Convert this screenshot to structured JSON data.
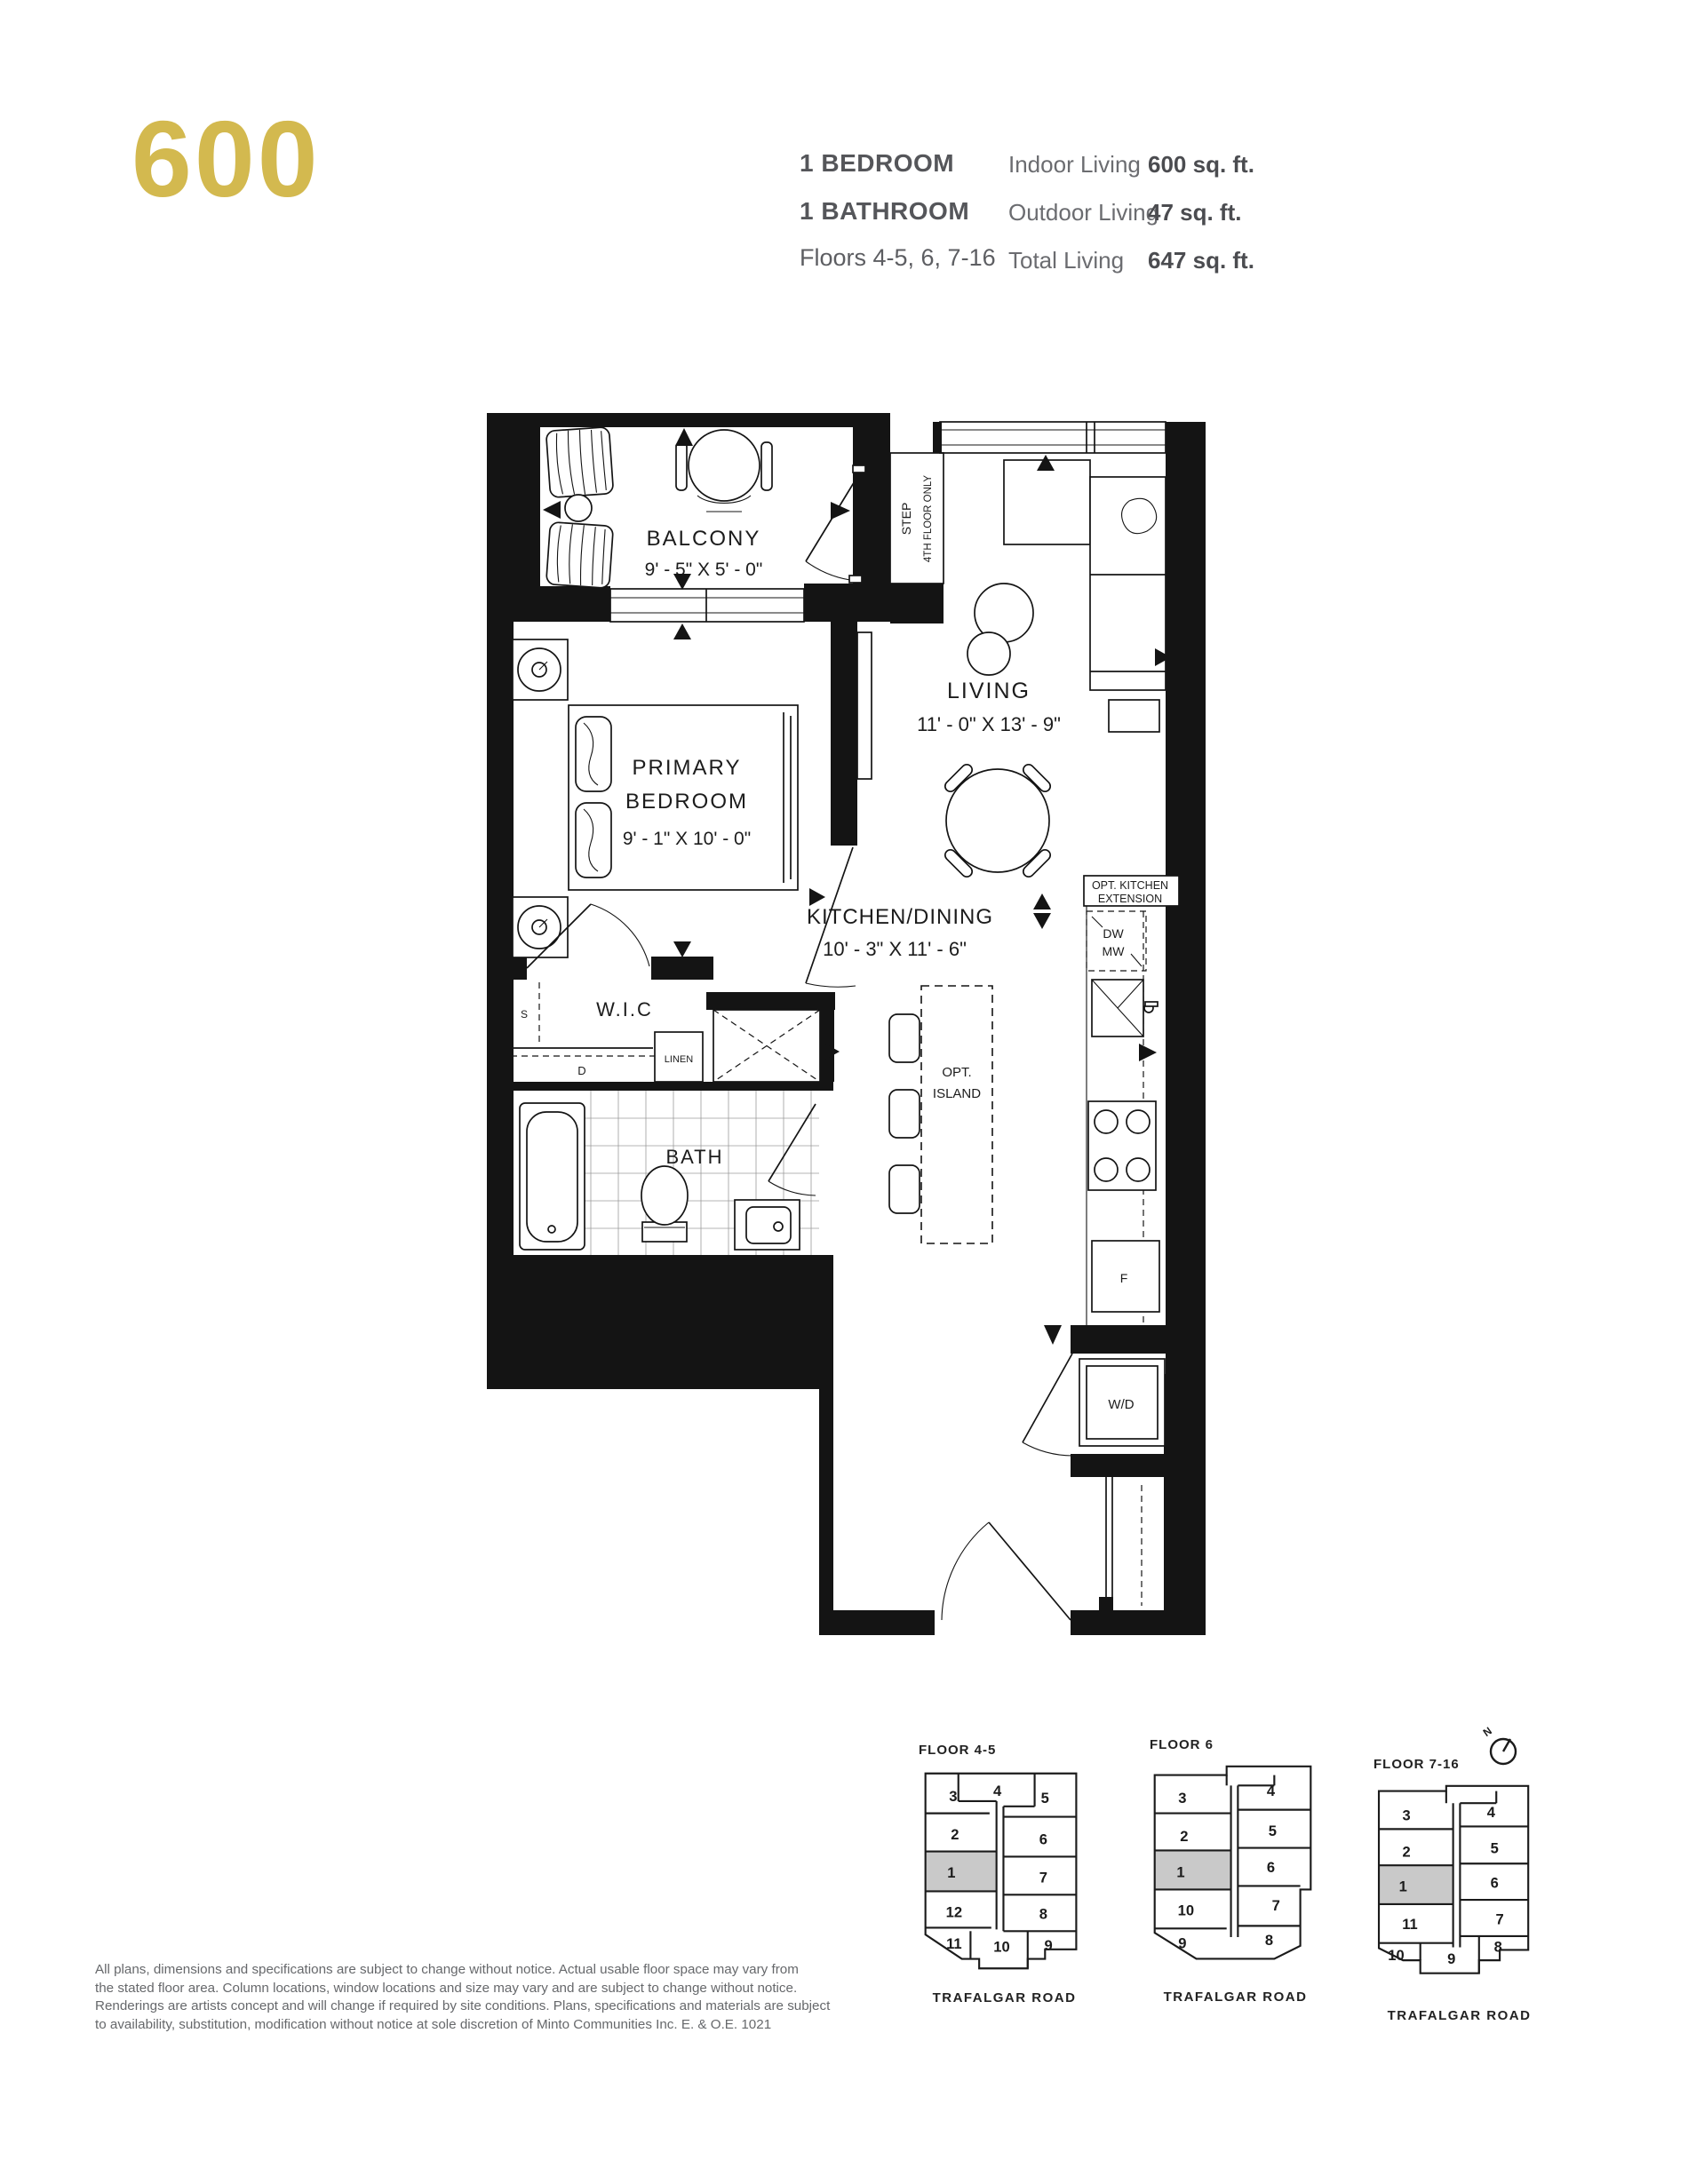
{
  "header": {
    "unit_number": "600",
    "bed": "1 BEDROOM",
    "bath": "1 BATHROOM",
    "floors": "Floors 4-5, 6, 7-16",
    "accent_color": "#d3b94f",
    "stats": [
      {
        "label": "Indoor Living",
        "value": "600 sq. ft."
      },
      {
        "label": "Outdoor Living",
        "value": "47 sq. ft."
      },
      {
        "label": "Total Living",
        "value": "647 sq. ft."
      }
    ]
  },
  "plan": {
    "balcony": {
      "name": "BALCONY",
      "dims": "9' - 5\" X 5' - 0\""
    },
    "bedroom": {
      "l1": "PRIMARY",
      "l2": "BEDROOM",
      "dims": "9' - 1\" X 10' - 0\""
    },
    "living": {
      "name": "LIVING",
      "dims": "11' - 0\" X 13' - 9\""
    },
    "kitchen": {
      "name": "KITCHEN/DINING",
      "dims": "10' - 3\" X 11' - 6\""
    },
    "step": {
      "l1": "STEP",
      "l2": "4TH FLOOR ONLY"
    },
    "labels": {
      "wic": "W.I.C",
      "linen": "LINEN",
      "s": "S",
      "d": "D",
      "bath": "BATH",
      "optk1": "OPT. KITCHEN",
      "optk2": "EXTENSION",
      "dw": "DW",
      "mw": "MW",
      "opti1": "OPT.",
      "opti2": "ISLAND",
      "f": "F",
      "wd": "W/D"
    }
  },
  "keyplans": [
    {
      "title": "FLOOR 4-5",
      "road": "TRAFALGAR ROAD",
      "highlight": "1",
      "units": [
        "1",
        "2",
        "3",
        "4",
        "5",
        "6",
        "7",
        "8",
        "9",
        "10",
        "11",
        "12"
      ]
    },
    {
      "title": "FLOOR 6",
      "road": "TRAFALGAR ROAD",
      "highlight": "1",
      "units": [
        "1",
        "2",
        "3",
        "4",
        "5",
        "6",
        "7",
        "8",
        "9",
        "10"
      ]
    },
    {
      "title": "FLOOR 7-16",
      "road": "TRAFALGAR ROAD",
      "highlight": "1",
      "north_label": "N",
      "units": [
        "1",
        "2",
        "3",
        "4",
        "5",
        "6",
        "7",
        "8",
        "9",
        "10",
        "11"
      ]
    }
  ],
  "disclaimer": {
    "lines": [
      "All plans, dimensions and specifications are subject to change without notice. Actual usable floor space may vary from",
      "the stated floor area. Column locations, window locations and size may vary and are subject to change without notice.",
      "Renderings are artists concept and will change if required by site conditions. Plans, specifications and materials are subject",
      "to availability, substitution, modification without notice at sole discretion of Minto Communities Inc.   E. & O.E. 1021"
    ]
  }
}
